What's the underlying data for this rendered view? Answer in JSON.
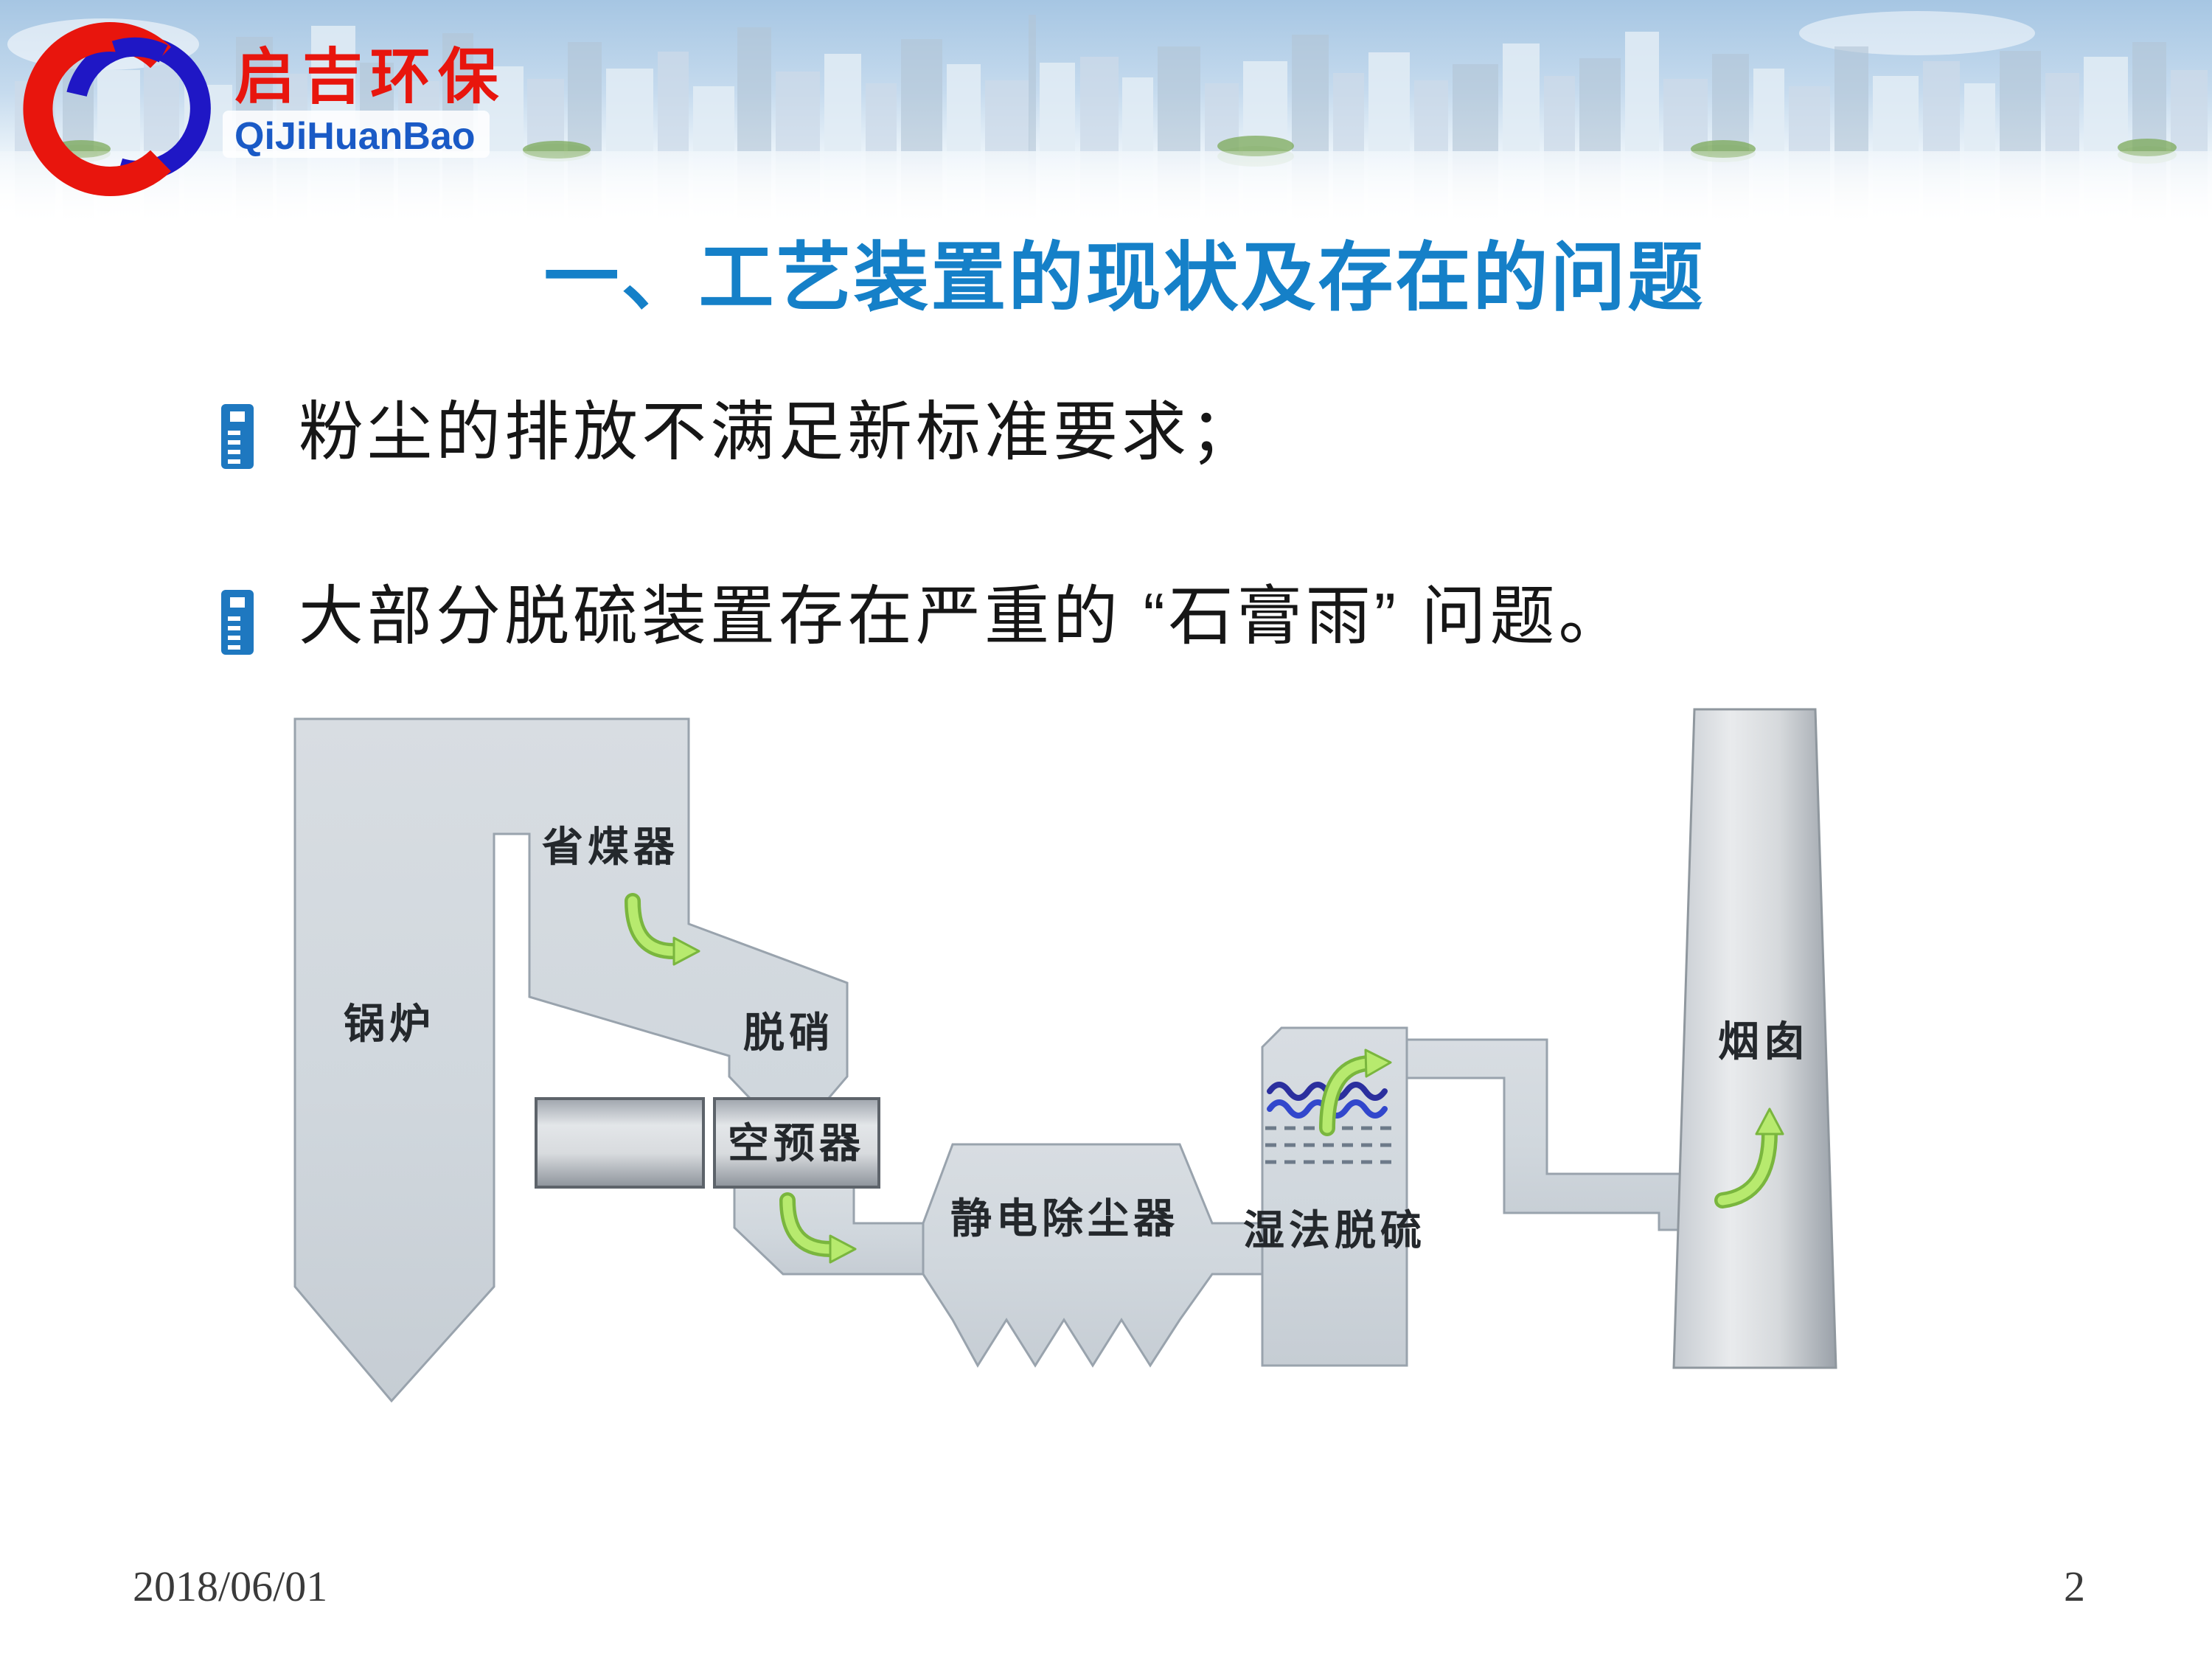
{
  "header": {
    "logo_text_cn": "启吉环保",
    "logo_text_en": "QiJiHuanBao",
    "logo_red": "#e8150d",
    "logo_blue": "#1f17c5"
  },
  "title": {
    "text": "一、工艺装置的现状及存在的问题",
    "color": "#1580c8"
  },
  "bullets": [
    {
      "text": "粉尘的排放不满足新标准要求；"
    },
    {
      "text": "大部分脱硫装置存在严重的 “石膏雨” 问题。"
    }
  ],
  "diagram": {
    "labels": {
      "boiler": "锅炉",
      "economizer": "省煤器",
      "denitration": "脱硝",
      "air_preheater": "空预器",
      "esp": "静电除尘器",
      "wet_fgd": "湿法脱硫",
      "chimney": "烟囱"
    },
    "arrow_color": "#b7ea6e",
    "shape_fill": "#d2d8de",
    "spray_wave_colors": [
      "#2b2f9e",
      "#3247cc"
    ]
  },
  "footer": {
    "date": "2018/06/01",
    "page_number": "2"
  }
}
